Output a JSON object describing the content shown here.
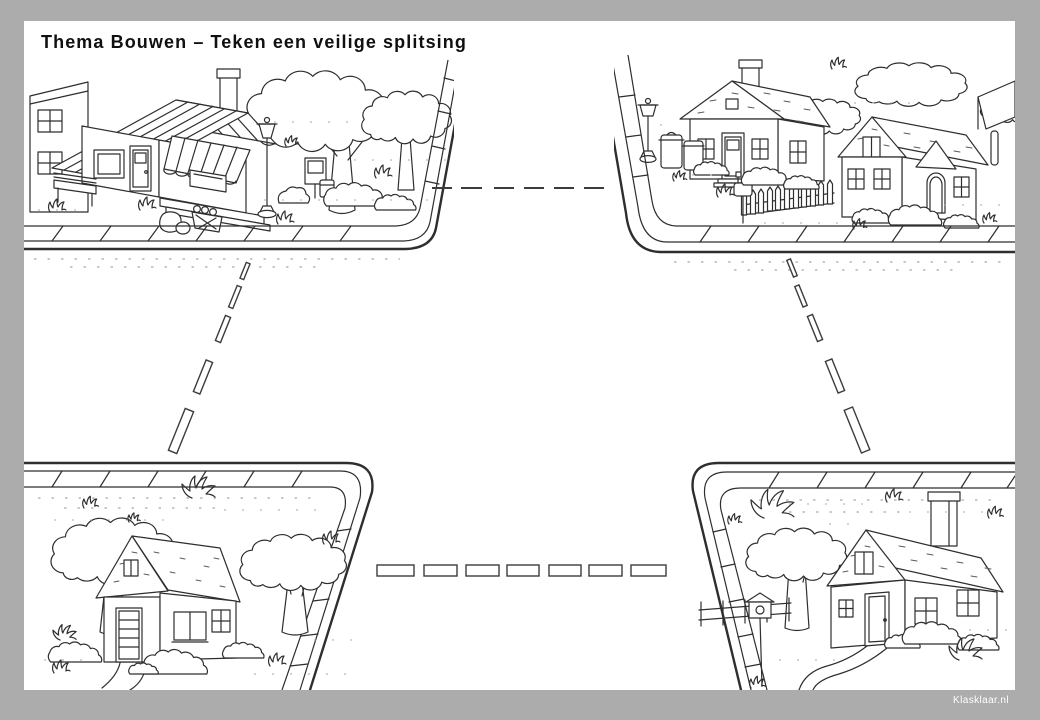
{
  "worksheet": {
    "title": "Thema Bouwen – Teken een veilige splitsing",
    "watermark": "Klasklaar.nl"
  },
  "palette": {
    "backdrop": "#acacac",
    "paper": "#ffffff",
    "ink": "#2e2e2e",
    "road_marking": "#3c3c3c"
  },
  "scenes": {
    "top_left": {
      "label": "Straathoek linksboven: winkeltje met gestreepte luifel, bankje, lantaarnpaal, bomen en flatgebouw"
    },
    "top_right": {
      "label": "Straathoek rechtsboven: twee huizen met hekje, brievenbus, lantaarnpaal en vuilnisbakken"
    },
    "bottom_left": {
      "label": "Straathoek linksonder: huisje tussen twee bomen met struiken"
    },
    "bottom_right": {
      "label": "Straathoek rechtsonder: huis met schoorsteen, boom, hekje en vogelhuisje"
    }
  },
  "road_markings": {
    "top": {
      "orientation": "horizontal",
      "dash_count": 6
    },
    "left": {
      "orientation": "diagonal",
      "dash_count": 5
    },
    "right": {
      "orientation": "diagonal",
      "dash_count": 5
    },
    "bottom": {
      "orientation": "horizontal",
      "dash_count": 7
    }
  }
}
